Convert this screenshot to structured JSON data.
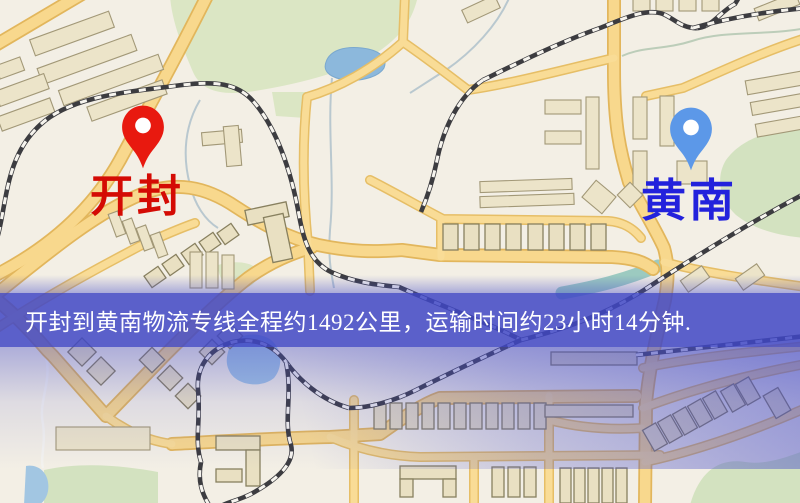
{
  "banner": {
    "text": "开封到黄南物流专线全程约1492公里，运输时间约23小时14分钟.",
    "background_color": "#4046c6",
    "text_color": "#ffffff"
  },
  "origin": {
    "name": "开封",
    "label_color": "#d40b04",
    "pin_color": "#e8190f"
  },
  "destination": {
    "name": "黄南",
    "label_color": "#2322dc",
    "pin_color": "#5c98e8"
  },
  "route": {
    "distance_text": "约1492公里",
    "duration_text": "约23小时14分钟"
  }
}
